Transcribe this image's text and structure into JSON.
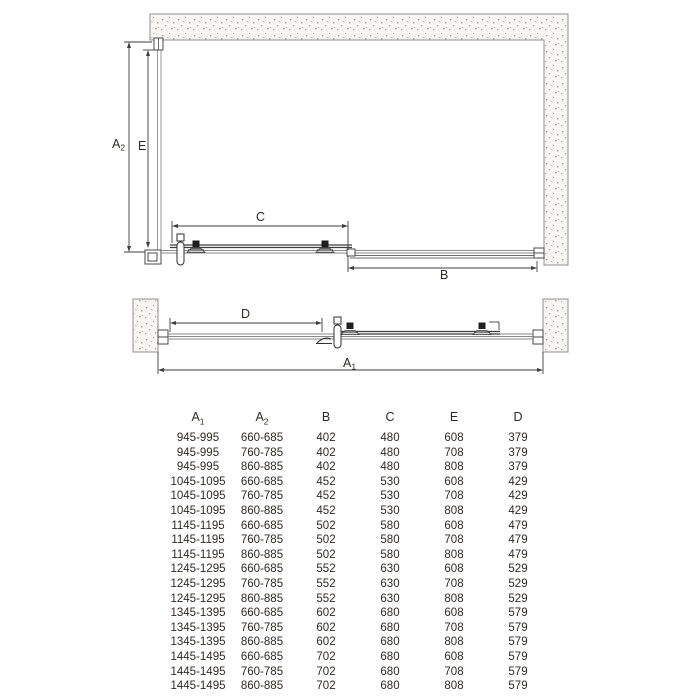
{
  "colors": {
    "wall_outline": "#8f8f8f",
    "wall_fill": "#f7f6f4",
    "speckle": "#a9a59e",
    "rail_gray": "#8a8a8a",
    "line_dark": "#3a3a3a",
    "text": "#2e2a26"
  },
  "diagrams": {
    "plan_view": {
      "labels": {
        "a2": {
          "base": "A",
          "sub": "2"
        },
        "e": "E",
        "c": "C",
        "b": "B"
      }
    },
    "front_view": {
      "labels": {
        "d": "D",
        "a1": {
          "base": "A",
          "sub": "1"
        }
      }
    }
  },
  "table": {
    "headers": [
      {
        "base": "A",
        "sub": "1"
      },
      {
        "base": "A",
        "sub": "2"
      },
      {
        "base": "B",
        "sub": ""
      },
      {
        "base": "C",
        "sub": ""
      },
      {
        "base": "E",
        "sub": ""
      },
      {
        "base": "D",
        "sub": ""
      }
    ],
    "rows": [
      [
        "945-995",
        "660-685",
        "402",
        "480",
        "608",
        "379"
      ],
      [
        "945-995",
        "760-785",
        "402",
        "480",
        "708",
        "379"
      ],
      [
        "945-995",
        "860-885",
        "402",
        "480",
        "808",
        "379"
      ],
      [
        "1045-1095",
        "660-685",
        "452",
        "530",
        "608",
        "429"
      ],
      [
        "1045-1095",
        "760-785",
        "452",
        "530",
        "708",
        "429"
      ],
      [
        "1045-1095",
        "860-885",
        "452",
        "530",
        "808",
        "429"
      ],
      [
        "1145-1195",
        "660-685",
        "502",
        "580",
        "608",
        "479"
      ],
      [
        "1145-1195",
        "760-785",
        "502",
        "580",
        "708",
        "479"
      ],
      [
        "1145-1195",
        "860-885",
        "502",
        "580",
        "808",
        "479"
      ],
      [
        "1245-1295",
        "660-685",
        "552",
        "630",
        "608",
        "529"
      ],
      [
        "1245-1295",
        "760-785",
        "552",
        "630",
        "708",
        "529"
      ],
      [
        "1245-1295",
        "860-885",
        "552",
        "630",
        "808",
        "529"
      ],
      [
        "1345-1395",
        "660-685",
        "602",
        "680",
        "608",
        "579"
      ],
      [
        "1345-1395",
        "760-785",
        "602",
        "680",
        "708",
        "579"
      ],
      [
        "1345-1395",
        "860-885",
        "602",
        "680",
        "808",
        "579"
      ],
      [
        "1445-1495",
        "660-685",
        "702",
        "680",
        "608",
        "579"
      ],
      [
        "1445-1495",
        "760-785",
        "702",
        "680",
        "708",
        "579"
      ],
      [
        "1445-1495",
        "860-885",
        "702",
        "680",
        "808",
        "579"
      ]
    ]
  }
}
